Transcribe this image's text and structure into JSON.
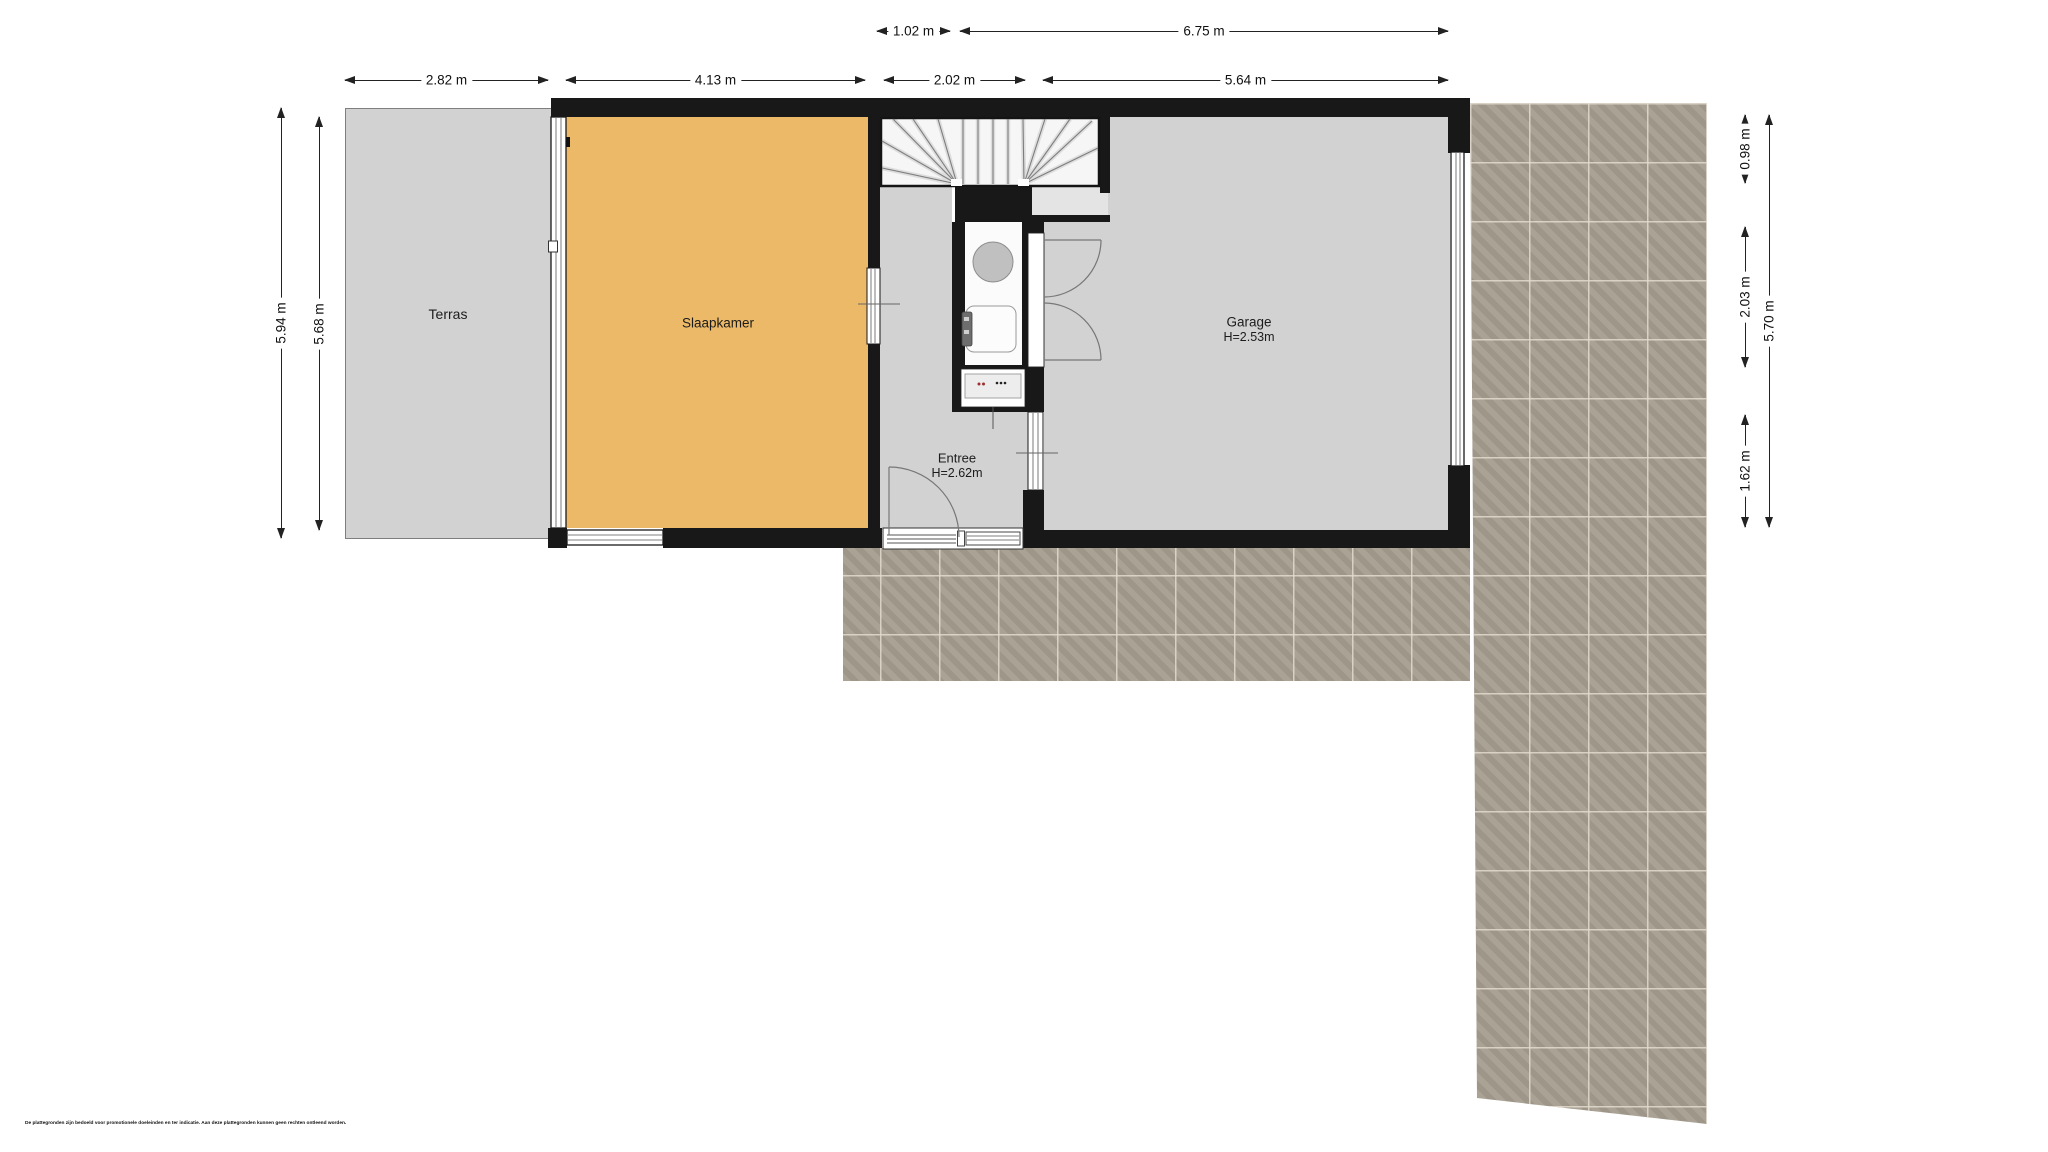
{
  "rooms": {
    "terras": {
      "label": "Terras"
    },
    "slaapkamer": {
      "label": "Slaapkamer"
    },
    "entree": {
      "label": "Entree",
      "height": "H=2.62m"
    },
    "garage": {
      "label": "Garage",
      "height": "H=2.53m"
    }
  },
  "dimensions": {
    "top_stairs": {
      "label": "1.02 m"
    },
    "top_right": {
      "label": "6.75 m"
    },
    "terras_w": {
      "label": "2.82 m"
    },
    "slaapkamer_w": {
      "label": "4.13 m"
    },
    "entree_w": {
      "label": "2.02 m"
    },
    "garage_w": {
      "label": "5.64 m"
    },
    "left_outer": {
      "label": "5.94 m"
    },
    "left_inner": {
      "label": "5.68 m"
    },
    "right_top": {
      "label": "0.98 m"
    },
    "right_mid": {
      "label": "2.03 m"
    },
    "right_low": {
      "label": "1.62 m"
    },
    "right_outer": {
      "label": "5.70 m"
    }
  },
  "disclaimer": "De plattegronden zijn bedoeld voor promotionele doeleinden en ter indicatie. Aan deze plattegronden kunnen geen rechten ontleend worden.",
  "colors": {
    "wall": "#181818",
    "bedroom_floor": "#ecb968",
    "room_floor": "#d2d2d2",
    "stair_floor": "#f6f6f6",
    "tile": "#a69e90",
    "tile_grout": "#ded6c6"
  }
}
